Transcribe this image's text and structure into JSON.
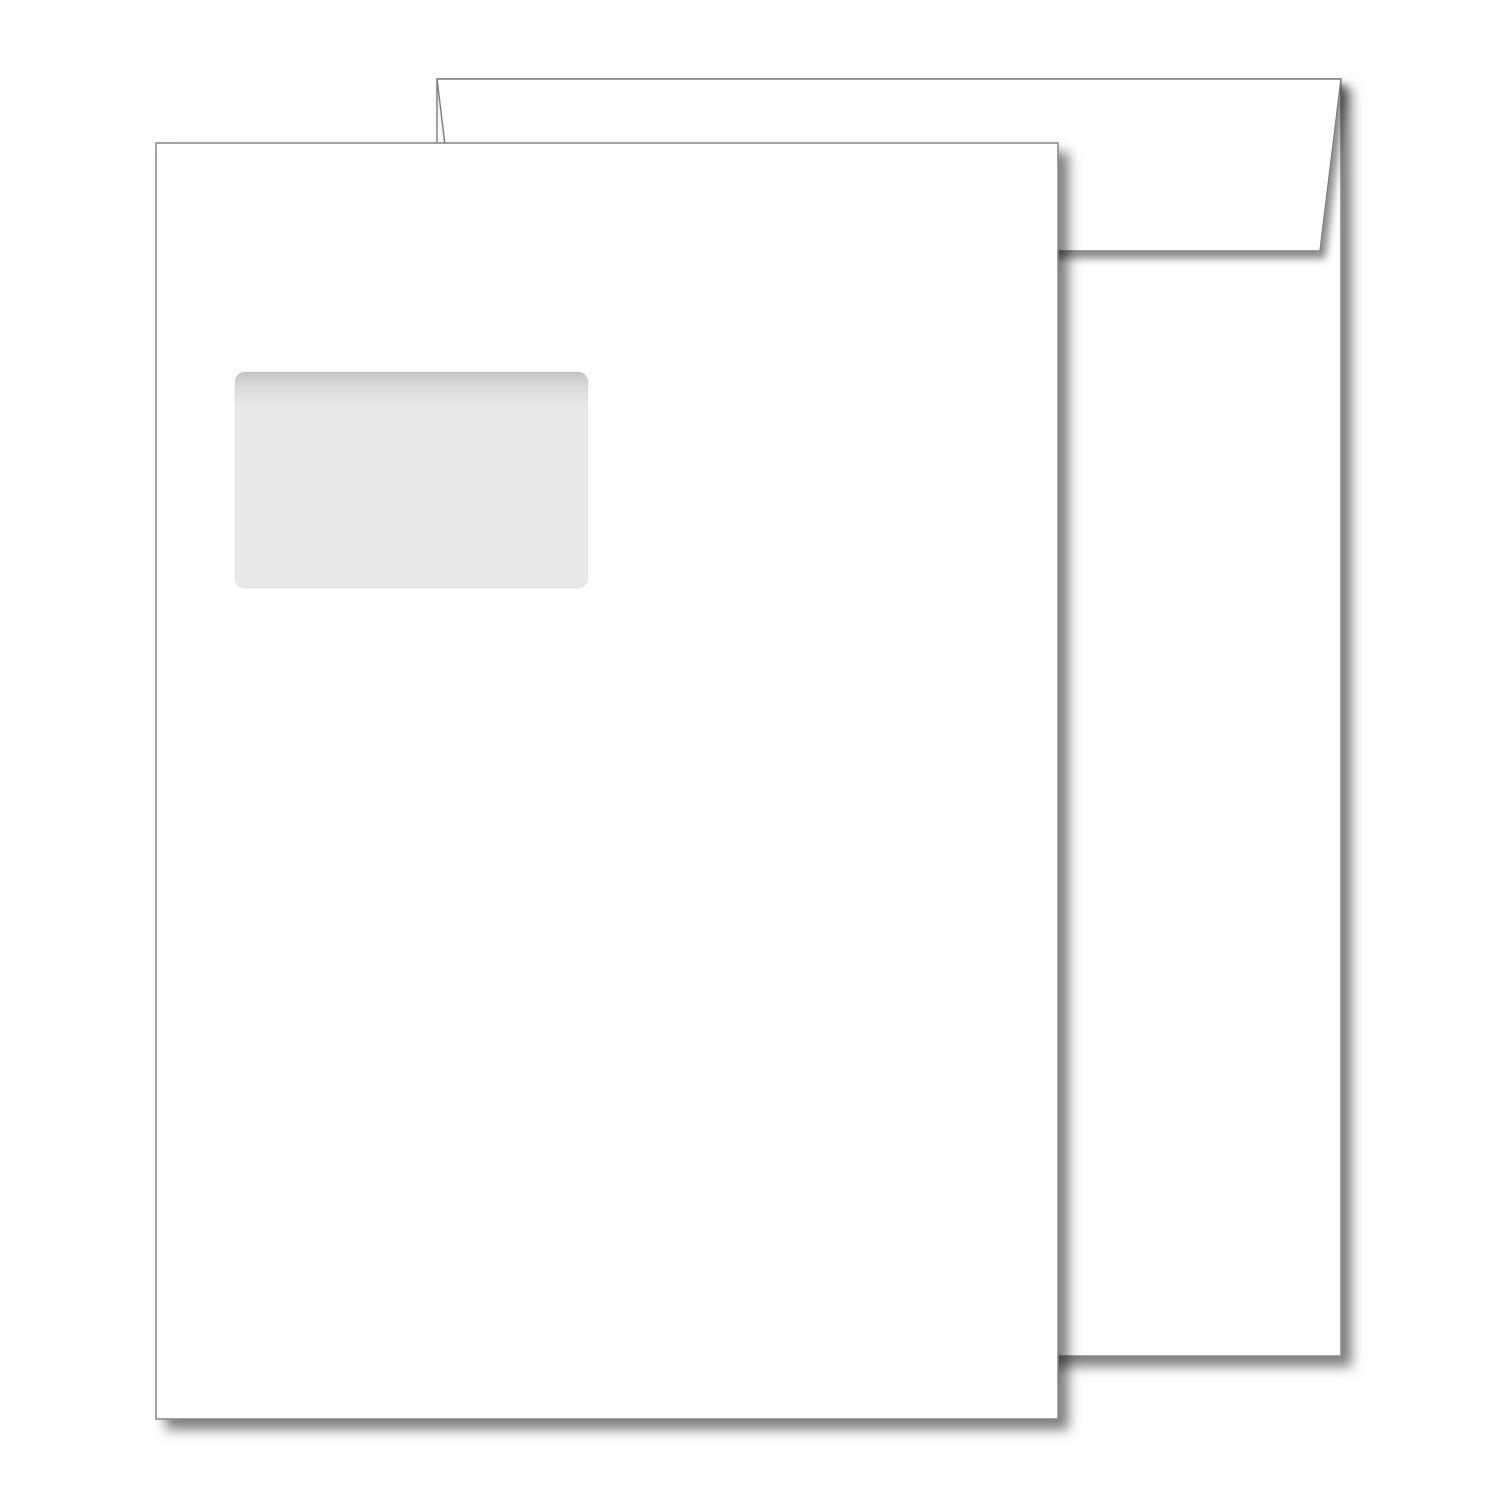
{
  "scene": {
    "kind": "product-image",
    "subject": "blank-window-envelopes"
  },
  "colors": {
    "background": "#ffffff",
    "paper": "#ffffff",
    "outline": "#7d7d7d",
    "window_fill": "#e9e9e9",
    "shadow": "#000000"
  },
  "objects": {
    "back_envelope": "envelope-back-with-flap",
    "front_envelope": "envelope-front-with-window",
    "window": "address-window"
  }
}
